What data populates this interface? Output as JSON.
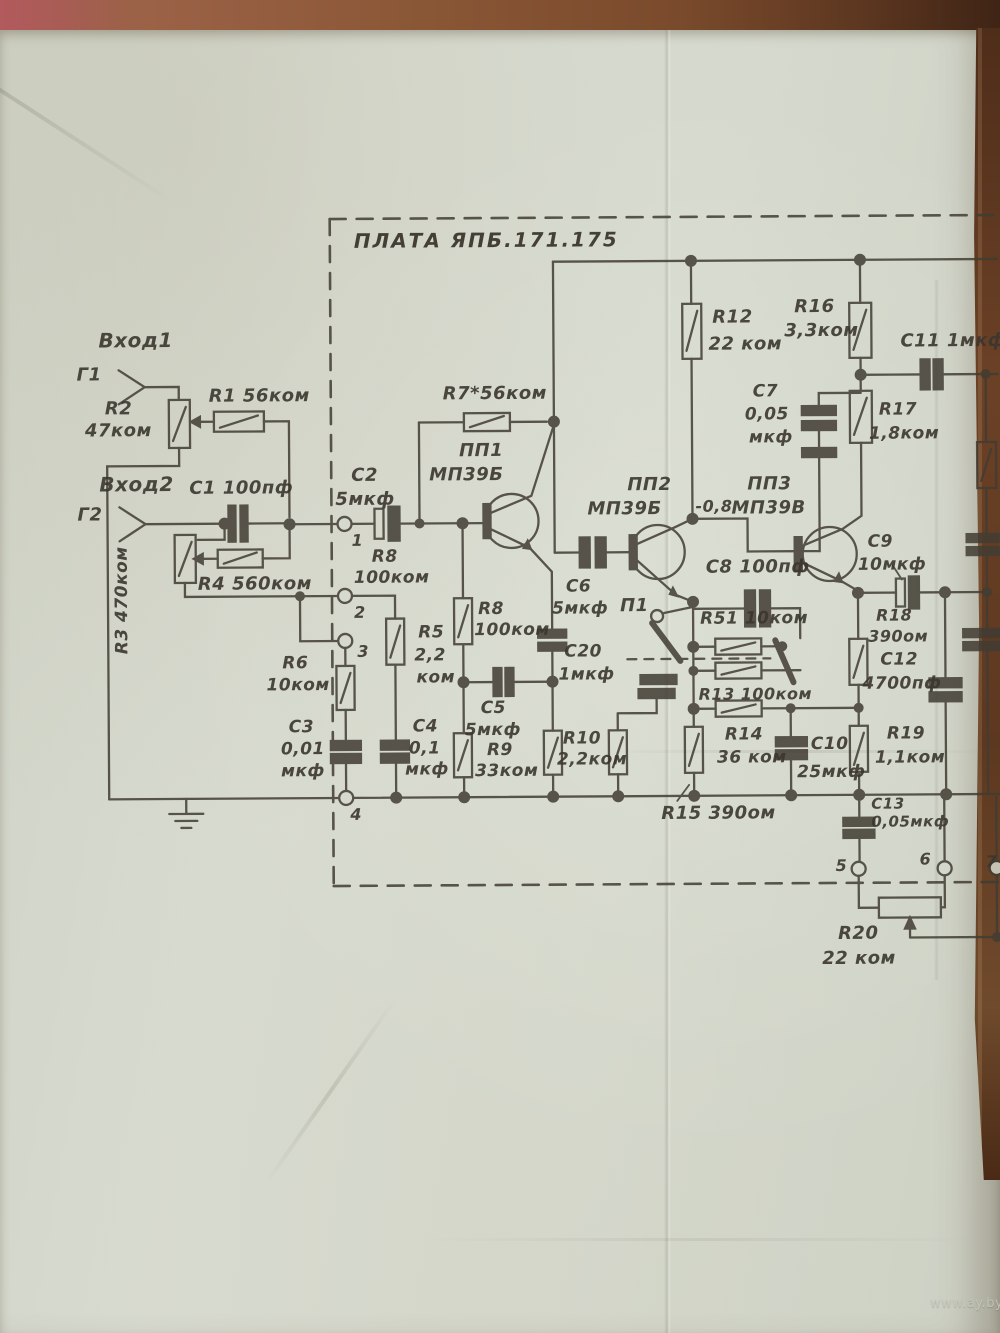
{
  "photo": {
    "watermark": "www.ay.by",
    "surface": "wooden table, paper sheet folded, aged green-grey",
    "paper_color": "#d6dace",
    "ink_color": "#3b372f",
    "wood_color": "#6b4126"
  },
  "schematic": {
    "title": "ПЛАТА ЯПБ.171.175",
    "inputs": [
      {
        "port": "Г1",
        "label": "Вход1"
      },
      {
        "port": "Г2",
        "label": "Вход2"
      }
    ],
    "terminals": [
      "1",
      "2",
      "3",
      "4",
      "5",
      "6",
      "7"
    ],
    "annotations": [
      "-0,8",
      "R7 marked with asterisk (selected on tuning)"
    ],
    "transistors": [
      {
        "ref": "ПП1",
        "type": "МП39Б"
      },
      {
        "ref": "ПП2",
        "type": "МП39Б"
      },
      {
        "ref": "ПП3",
        "type": "МП39В"
      }
    ],
    "switch": {
      "ref": "П1"
    },
    "resistors": [
      {
        "ref": "R1",
        "value": "56ком"
      },
      {
        "ref": "R2",
        "value": "47ком"
      },
      {
        "ref": "R3",
        "value": "470ком"
      },
      {
        "ref": "R4",
        "value": "560ком"
      },
      {
        "ref": "R5",
        "value": "2,2ком"
      },
      {
        "ref": "R6",
        "value": "10ком"
      },
      {
        "ref": "R7*",
        "value": "56ком"
      },
      {
        "ref": "R8",
        "value": "100ком"
      },
      {
        "ref": "R9",
        "value": "33ком"
      },
      {
        "ref": "R10",
        "value": "2,2ком"
      },
      {
        "ref": "R12",
        "value": "22 ком"
      },
      {
        "ref": "R13",
        "value": "100ком"
      },
      {
        "ref": "R14",
        "value": "36 ком"
      },
      {
        "ref": "R15",
        "value": "390ом"
      },
      {
        "ref": "R16",
        "value": "3,3ком"
      },
      {
        "ref": "R17",
        "value": "1,8ком"
      },
      {
        "ref": "R18",
        "value": "390ом"
      },
      {
        "ref": "R19",
        "value": "1,1ком"
      },
      {
        "ref": "R20",
        "value": "22 ком"
      },
      {
        "ref": "R51",
        "value": "10ком"
      }
    ],
    "capacitors": [
      {
        "ref": "С1",
        "value": "100пф"
      },
      {
        "ref": "С2",
        "value": "5мкф"
      },
      {
        "ref": "С3",
        "value": "0,01мкф"
      },
      {
        "ref": "С4",
        "value": "0,1мкф"
      },
      {
        "ref": "С5",
        "value": "5мкф"
      },
      {
        "ref": "С6",
        "value": "5мкф"
      },
      {
        "ref": "С7",
        "value": "0,05мкф"
      },
      {
        "ref": "С8",
        "value": "100пф"
      },
      {
        "ref": "С9",
        "value": "10мкф"
      },
      {
        "ref": "С10",
        "value": "25мкф"
      },
      {
        "ref": "С11",
        "value": "1мкф"
      },
      {
        "ref": "С12",
        "value": "4700пф"
      },
      {
        "ref": "С13",
        "value": "0,05мкф"
      },
      {
        "ref": "С20",
        "value": "1мкф"
      }
    ],
    "labels": [
      {
        "t": "Вход1",
        "x": 100,
        "y": 326,
        "fs": 20
      },
      {
        "t": "Г1",
        "x": 78,
        "y": 362,
        "fs": 18
      },
      {
        "t": "R2",
        "x": 106,
        "y": 396,
        "fs": 18
      },
      {
        "t": "47ком",
        "x": 86,
        "y": 418,
        "fs": 18
      },
      {
        "t": "R1 56ком",
        "x": 210,
        "y": 384,
        "fs": 18
      },
      {
        "t": "Вход2",
        "x": 100,
        "y": 470,
        "fs": 20
      },
      {
        "t": "Г2",
        "x": 78,
        "y": 502,
        "fs": 18
      },
      {
        "t": "С1 100пф",
        "x": 190,
        "y": 476,
        "fs": 18
      },
      {
        "t": "R4 560ком",
        "x": 198,
        "y": 572,
        "fs": 18
      },
      {
        "t": "R3 470ком",
        "x": 112,
        "y": 652,
        "fs": 17,
        "rot": -90
      },
      {
        "t": "R6",
        "x": 282,
        "y": 652,
        "fs": 17
      },
      {
        "t": "10ком",
        "x": 266,
        "y": 674,
        "fs": 17
      },
      {
        "t": "С3",
        "x": 288,
        "y": 716,
        "fs": 17
      },
      {
        "t": "0,01",
        "x": 280,
        "y": 738,
        "fs": 17
      },
      {
        "t": "мкф",
        "x": 280,
        "y": 760,
        "fs": 17
      },
      {
        "t": "1",
        "x": 352,
        "y": 530,
        "fs": 16
      },
      {
        "t": "2",
        "x": 354,
        "y": 602,
        "fs": 16
      },
      {
        "t": "3",
        "x": 357,
        "y": 641,
        "fs": 16
      },
      {
        "t": "4",
        "x": 349,
        "y": 804,
        "fs": 16
      },
      {
        "t": "С2",
        "x": 352,
        "y": 464,
        "fs": 18
      },
      {
        "t": "5мкф",
        "x": 336,
        "y": 488,
        "fs": 18
      },
      {
        "t": "R8",
        "x": 372,
        "y": 546,
        "fs": 17
      },
      {
        "t": "100ком",
        "x": 354,
        "y": 567,
        "fs": 17
      },
      {
        "t": "R7*56ком",
        "x": 444,
        "y": 383,
        "fs": 18
      },
      {
        "t": "ПП1",
        "x": 460,
        "y": 440,
        "fs": 18
      },
      {
        "t": "МП39Б",
        "x": 430,
        "y": 464,
        "fs": 18
      },
      {
        "t": "R5",
        "x": 418,
        "y": 622,
        "fs": 17
      },
      {
        "t": "2,2",
        "x": 414,
        "y": 645,
        "fs": 17
      },
      {
        "t": "ком",
        "x": 416,
        "y": 667,
        "fs": 17
      },
      {
        "t": "R8",
        "x": 478,
        "y": 599,
        "fs": 17
      },
      {
        "t": "100ком",
        "x": 474,
        "y": 620,
        "fs": 17
      },
      {
        "t": "С6",
        "x": 566,
        "y": 577,
        "fs": 17
      },
      {
        "t": "5мкф",
        "x": 552,
        "y": 599,
        "fs": 17
      },
      {
        "t": "С20",
        "x": 564,
        "y": 642,
        "fs": 17
      },
      {
        "t": "1мкф",
        "x": 558,
        "y": 665,
        "fs": 17
      },
      {
        "t": "С5",
        "x": 480,
        "y": 698,
        "fs": 17
      },
      {
        "t": "5мкф",
        "x": 464,
        "y": 720,
        "fs": 17
      },
      {
        "t": "С4",
        "x": 412,
        "y": 716,
        "fs": 17
      },
      {
        "t": "0,1",
        "x": 408,
        "y": 738,
        "fs": 17
      },
      {
        "t": "мкф",
        "x": 404,
        "y": 759,
        "fs": 17
      },
      {
        "t": "R9",
        "x": 486,
        "y": 740,
        "fs": 17
      },
      {
        "t": "33ком",
        "x": 474,
        "y": 761,
        "fs": 17
      },
      {
        "t": "R10",
        "x": 562,
        "y": 729,
        "fs": 17
      },
      {
        "t": "2,2ком",
        "x": 556,
        "y": 750,
        "fs": 17
      },
      {
        "t": "ПП2",
        "x": 628,
        "y": 475,
        "fs": 18
      },
      {
        "t": "МП39Б",
        "x": 588,
        "y": 499,
        "fs": 18
      },
      {
        "t": "-0,8",
        "x": 696,
        "y": 498,
        "fs": 16
      },
      {
        "t": "ПП3",
        "x": 748,
        "y": 475,
        "fs": 18
      },
      {
        "t": "МП39В",
        "x": 732,
        "y": 499,
        "fs": 18
      },
      {
        "t": "С8 100пф",
        "x": 706,
        "y": 558,
        "fs": 18
      },
      {
        "t": "П1",
        "x": 620,
        "y": 596,
        "fs": 18
      },
      {
        "t": "R51 10ком",
        "x": 700,
        "y": 610,
        "fs": 17
      },
      {
        "t": "R13 100ком",
        "x": 698,
        "y": 686,
        "fs": 16
      },
      {
        "t": "R12",
        "x": 714,
        "y": 308,
        "fs": 18
      },
      {
        "t": "22 ком",
        "x": 710,
        "y": 335,
        "fs": 18
      },
      {
        "t": "R16",
        "x": 796,
        "y": 298,
        "fs": 18
      },
      {
        "t": "3,3ком",
        "x": 786,
        "y": 322,
        "fs": 18
      },
      {
        "t": "С7",
        "x": 754,
        "y": 383,
        "fs": 17
      },
      {
        "t": "0,05",
        "x": 746,
        "y": 406,
        "fs": 17
      },
      {
        "t": "мкф",
        "x": 750,
        "y": 429,
        "fs": 17
      },
      {
        "t": "С11 1мкф",
        "x": 902,
        "y": 333,
        "fs": 18
      },
      {
        "t": "R17",
        "x": 880,
        "y": 402,
        "fs": 17
      },
      {
        "t": "1,8ком",
        "x": 870,
        "y": 426,
        "fs": 17
      },
      {
        "t": "С9",
        "x": 868,
        "y": 534,
        "fs": 17
      },
      {
        "t": "10мкф",
        "x": 858,
        "y": 557,
        "fs": 17
      },
      {
        "t": "R18",
        "x": 876,
        "y": 608,
        "fs": 16
      },
      {
        "t": "390ом",
        "x": 868,
        "y": 629,
        "fs": 16
      },
      {
        "t": "С12",
        "x": 880,
        "y": 652,
        "fs": 17
      },
      {
        "t": "4700пф",
        "x": 862,
        "y": 676,
        "fs": 17
      },
      {
        "t": "R14",
        "x": 724,
        "y": 726,
        "fs": 17
      },
      {
        "t": "36 ком",
        "x": 716,
        "y": 749,
        "fs": 17
      },
      {
        "t": "С10",
        "x": 810,
        "y": 736,
        "fs": 17
      },
      {
        "t": "25мкф",
        "x": 796,
        "y": 764,
        "fs": 17
      },
      {
        "t": "R19",
        "x": 886,
        "y": 726,
        "fs": 17
      },
      {
        "t": "1,1ком",
        "x": 874,
        "y": 750,
        "fs": 17
      },
      {
        "t": "R15 390ом",
        "x": 660,
        "y": 804,
        "fs": 18
      },
      {
        "t": "С13",
        "x": 870,
        "y": 797,
        "fs": 15
      },
      {
        "t": "0,05мкф",
        "x": 870,
        "y": 815,
        "fs": 15
      },
      {
        "t": "R20",
        "x": 836,
        "y": 925,
        "fs": 18
      },
      {
        "t": "22 ком",
        "x": 820,
        "y": 950,
        "fs": 18
      },
      {
        "t": "5",
        "x": 834,
        "y": 858,
        "fs": 16
      },
      {
        "t": "6",
        "x": 918,
        "y": 852,
        "fs": 16
      },
      {
        "t": "7",
        "x": 984,
        "y": 855,
        "fs": 16
      }
    ]
  }
}
